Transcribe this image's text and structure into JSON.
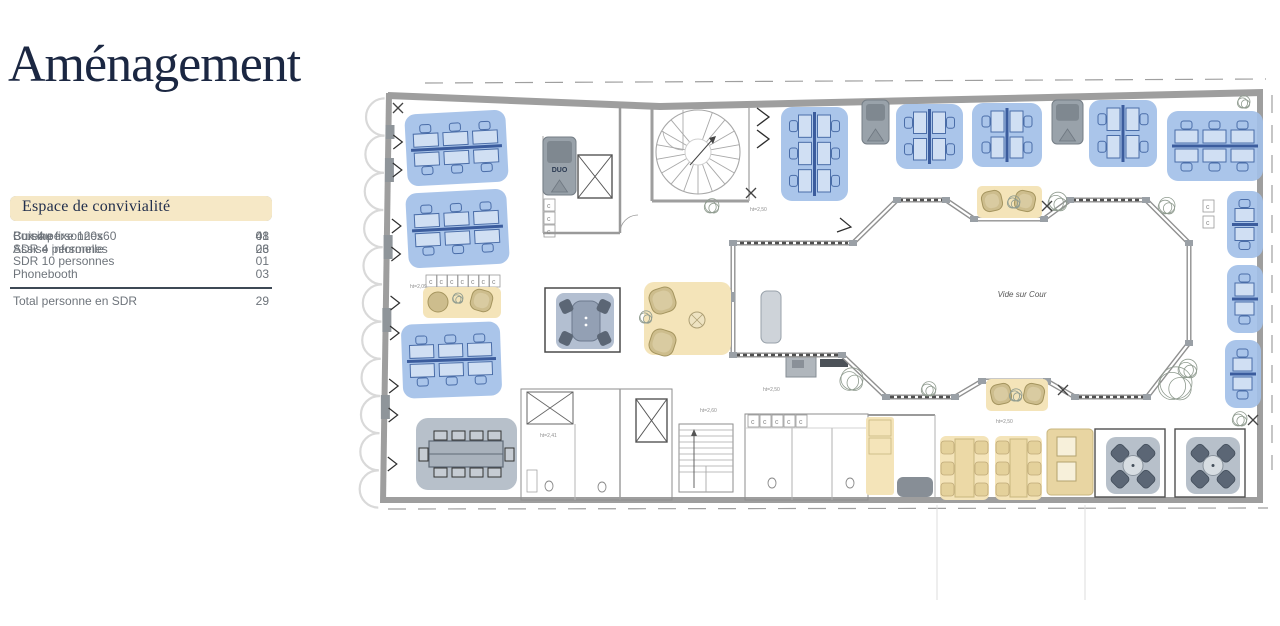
{
  "title": "Aménagement",
  "legend": {
    "sections": [
      {
        "id": "travail",
        "header": "Espace de travail",
        "color": "#abc4e9",
        "items": [
          {
            "label": "Bureau fixe 120x60",
            "value": "48"
          }
        ]
      },
      {
        "id": "reunion",
        "header": "Espace de réunion",
        "color": "#b7bdc6",
        "items": [
          {
            "label": "Box 4 personnes",
            "value": "01"
          },
          {
            "label": "SDR 4 personnes",
            "value": "03"
          },
          {
            "label": "SDR 10 personnes",
            "value": "01"
          },
          {
            "label": "Phonebooth",
            "value": "03"
          }
        ],
        "total": {
          "label": "Total personne en SDR",
          "value": "29"
        }
      },
      {
        "id": "convivialite",
        "header": "Espace de convivialité",
        "color": "#f6e8c6",
        "items": [
          {
            "label": "Cuisine",
            "value": "01"
          },
          {
            "label": "Assise informelle",
            "value": "26"
          }
        ]
      }
    ]
  },
  "floorplan": {
    "labels": {
      "courtyard": "Vide sur Cour",
      "phonebooth": "DUO"
    },
    "colors": {
      "desk_zone": "#a3c0e8",
      "desk_line": "#4a6da8",
      "spine": "#3b5c9d",
      "social_zone": "#f4e4b9",
      "tan": "#cdbd8d",
      "tan_dark": "#a5955f",
      "meeting_zone": "#b7c0ca",
      "dark_chair": "#5b6675",
      "booth": "#99a2aa",
      "wall": "#9e9e9e",
      "structure": "#aaaaaa"
    },
    "desk_clusters": [
      {
        "x": 406,
        "y": 112,
        "w": 101,
        "h": 72,
        "type": "h",
        "cols": 3,
        "rot": -3
      },
      {
        "x": 407,
        "y": 191,
        "w": 101,
        "h": 75,
        "type": "h",
        "cols": 3,
        "rot": -3
      },
      {
        "x": 402,
        "y": 323,
        "w": 99,
        "h": 74,
        "type": "h",
        "cols": 3,
        "rot": -2
      },
      {
        "x": 781,
        "y": 107,
        "w": 67,
        "h": 94,
        "type": "v",
        "rows": 3
      },
      {
        "x": 896,
        "y": 104,
        "w": 67,
        "h": 65,
        "type": "v",
        "rows": 2
      },
      {
        "x": 972,
        "y": 103,
        "w": 70,
        "h": 64,
        "type": "v",
        "rows": 2
      },
      {
        "x": 1089,
        "y": 100,
        "w": 68,
        "h": 67,
        "type": "v",
        "rows": 2
      },
      {
        "x": 1167,
        "y": 111,
        "w": 96,
        "h": 70,
        "type": "h",
        "cols": 3
      },
      {
        "x": 1227,
        "y": 191,
        "w": 36,
        "h": 67,
        "type": "h",
        "cols": 1
      },
      {
        "x": 1227,
        "y": 265,
        "w": 36,
        "h": 68,
        "type": "h",
        "cols": 1
      },
      {
        "x": 1225,
        "y": 340,
        "w": 36,
        "h": 68,
        "type": "h",
        "cols": 1
      }
    ],
    "phonebooths": [
      {
        "x": 543,
        "y": 137,
        "w": 33,
        "h": 58,
        "label": "DUO"
      },
      {
        "x": 862,
        "y": 100,
        "w": 27,
        "h": 44
      },
      {
        "x": 1052,
        "y": 100,
        "w": 31,
        "h": 44
      }
    ],
    "meeting_rooms": {
      "box4": {
        "wall": {
          "x": 545,
          "y": 288,
          "w": 75,
          "h": 64
        },
        "zone": {
          "x": 556,
          "y": 293,
          "w": 58,
          "h": 56
        }
      },
      "sdr10": {
        "x": 416,
        "y": 418,
        "w": 101,
        "h": 72
      },
      "sdr4": [
        {
          "x": 1106,
          "y": 437,
          "w": 54,
          "h": 57
        },
        {
          "x": 1186,
          "y": 437,
          "w": 54,
          "h": 57
        }
      ]
    },
    "social": {
      "lounge": {
        "x": 644,
        "y": 282,
        "w": 87,
        "h": 73
      },
      "informal_left": {
        "x": 423,
        "y": 287,
        "w": 78,
        "h": 31
      },
      "nook_top": {
        "x": 977,
        "y": 186,
        "w": 65,
        "h": 32
      },
      "nook_bottom": {
        "x": 986,
        "y": 379,
        "w": 62,
        "h": 32
      },
      "kitchen_counter": {
        "x": 866,
        "y": 417,
        "w": 28,
        "h": 78
      },
      "kitchen_tables": [
        {
          "x": 940,
          "y": 436,
          "w": 49,
          "h": 64
        },
        {
          "x": 995,
          "y": 436,
          "w": 47,
          "h": 64
        }
      ],
      "booth_seating": {
        "x": 1047,
        "y": 429,
        "w": 46,
        "h": 66
      }
    },
    "courtyard_outline": [
      [
        733,
        243
      ],
      [
        853,
        243
      ],
      [
        897,
        200
      ],
      [
        946,
        200
      ],
      [
        974,
        219
      ],
      [
        1044,
        219
      ],
      [
        1070,
        200
      ],
      [
        1146,
        200
      ],
      [
        1189,
        243
      ],
      [
        1189,
        343
      ],
      [
        1147,
        397
      ],
      [
        1075,
        397
      ],
      [
        1047,
        381
      ],
      [
        982,
        381
      ],
      [
        955,
        397
      ],
      [
        886,
        397
      ],
      [
        842,
        355
      ],
      [
        733,
        355
      ]
    ],
    "railing_hatches": [
      [
        740,
        243,
        848,
        243
      ],
      [
        899,
        200,
        944,
        200
      ],
      [
        1072,
        200,
        1143,
        200
      ],
      [
        890,
        397,
        952,
        397
      ],
      [
        1078,
        397,
        1144,
        397
      ],
      [
        736,
        355,
        838,
        355
      ]
    ],
    "trees": [
      {
        "x": 712,
        "y": 207,
        "r": 7
      },
      {
        "x": 1058,
        "y": 203,
        "r": 9
      },
      {
        "x": 1167,
        "y": 207,
        "r": 8
      },
      {
        "x": 852,
        "y": 381,
        "r": 11
      },
      {
        "x": 929,
        "y": 390,
        "r": 7
      },
      {
        "x": 1176,
        "y": 386,
        "r": 16
      },
      {
        "x": 1014,
        "y": 203,
        "r": 6
      },
      {
        "x": 1016,
        "y": 396,
        "r": 6
      },
      {
        "x": 1240,
        "y": 420,
        "r": 7
      },
      {
        "x": 1244,
        "y": 103,
        "r": 6
      },
      {
        "x": 1188,
        "y": 370,
        "r": 9
      }
    ],
    "xmarks": [
      [
        1047,
        206
      ],
      [
        1063,
        390
      ],
      [
        398,
        108
      ],
      [
        1253,
        420
      ],
      [
        751,
        193
      ]
    ],
    "dims": [
      {
        "x": 750,
        "y": 211,
        "t": "ht=2,50"
      },
      {
        "x": 996,
        "y": 423,
        "t": "ht=2,50"
      },
      {
        "x": 540,
        "y": 437,
        "t": "ht=2,41"
      },
      {
        "x": 700,
        "y": 412,
        "t": "ht=2,60"
      },
      {
        "x": 410,
        "y": 288,
        "t": "ht=2,09"
      },
      {
        "x": 763,
        "y": 391,
        "t": "ht=2,50"
      }
    ]
  }
}
